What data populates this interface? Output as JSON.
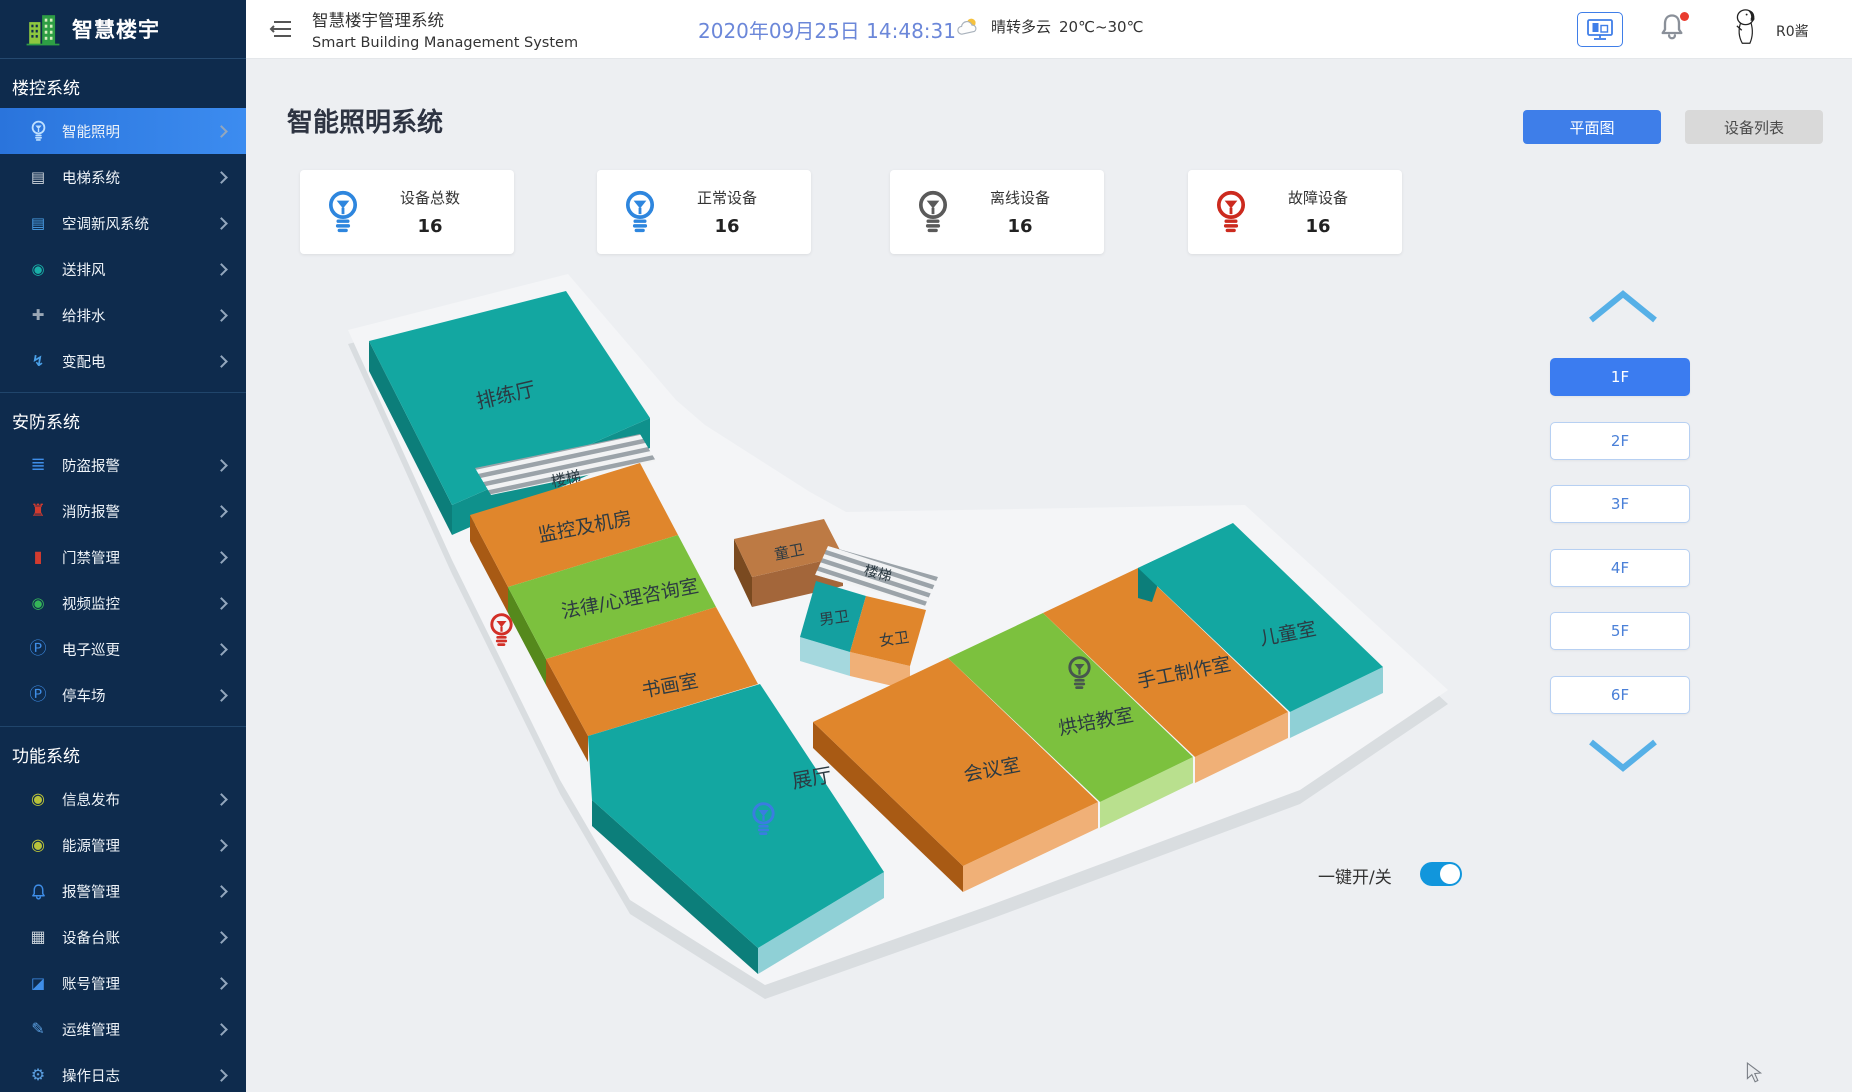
{
  "sidebar": {
    "logo_title": "智慧楼宇",
    "sections": [
      {
        "title": "楼控系统",
        "items": [
          {
            "label": "智能照明",
            "icon": "bulb-icon",
            "active": true
          },
          {
            "label": "电梯系统",
            "icon": "elevator-icon"
          },
          {
            "label": "空调新风系统",
            "icon": "air-conditioner-icon"
          },
          {
            "label": "送排风",
            "icon": "fan-icon"
          },
          {
            "label": "给排水",
            "icon": "water-valve-icon"
          },
          {
            "label": "变配电",
            "icon": "power-distribution-icon"
          }
        ]
      },
      {
        "title": "安防系统",
        "items": [
          {
            "label": "防盗报警",
            "icon": "burglar-alarm-icon"
          },
          {
            "label": "消防报警",
            "icon": "fire-hydrant-icon"
          },
          {
            "label": "门禁管理",
            "icon": "door-access-icon"
          },
          {
            "label": "视频监控",
            "icon": "camera-icon"
          },
          {
            "label": "电子巡更",
            "icon": "patrol-icon"
          },
          {
            "label": "停车场",
            "icon": "parking-icon"
          }
        ]
      },
      {
        "title": "功能系统",
        "items": [
          {
            "label": "信息发布",
            "icon": "info-publish-icon"
          },
          {
            "label": "能源管理",
            "icon": "energy-icon"
          },
          {
            "label": "报警管理",
            "icon": "alarm-bell-icon"
          },
          {
            "label": "设备台账",
            "icon": "device-ledger-icon"
          },
          {
            "label": "账号管理",
            "icon": "account-icon"
          },
          {
            "label": "运维管理",
            "icon": "ops-icon"
          },
          {
            "label": "操作日志",
            "icon": "log-icon"
          }
        ]
      }
    ]
  },
  "header": {
    "title": "智慧楼宇管理系统",
    "subtitle": "Smart Building Management System",
    "datetime": "2020年09月25日 14:48:31",
    "weather_condition": "晴转多云",
    "weather_temp": "20℃~30℃",
    "username": "R0酱"
  },
  "page": {
    "title": "智能照明系统",
    "btn_floorplan": "平面图",
    "btn_device_list": "设备列表"
  },
  "stats": [
    {
      "label": "设备总数",
      "value": "16",
      "color": "#2e86de"
    },
    {
      "label": "正常设备",
      "value": "16",
      "color": "#2e86de"
    },
    {
      "label": "离线设备",
      "value": "16",
      "color": "#5a5a5a"
    },
    {
      "label": "故障设备",
      "value": "16",
      "color": "#cc2a1e"
    }
  ],
  "floorplan": {
    "rooms": [
      "排练厅",
      "楼梯",
      "监控及机房",
      "法律/心理咨询室",
      "书画室",
      "展厅",
      "童卫",
      "楼梯",
      "男卫",
      "女卫",
      "会议室",
      "烘培教室",
      "手工制作室",
      "儿童室"
    ],
    "devices": [
      {
        "status": "fault",
        "color": "#d22f27"
      },
      {
        "status": "on",
        "color": "#3a7de0"
      },
      {
        "status": "offline",
        "color": "#47564e"
      }
    ]
  },
  "floor_selector": {
    "floors": [
      "1F",
      "2F",
      "3F",
      "4F",
      "5F",
      "6F"
    ],
    "active_floor": "1F"
  },
  "master_switch": {
    "label": "一键开/关",
    "state": "on"
  },
  "colors": {
    "accent_blue": "#3e7ee9",
    "sidebar_bg": "#0e2b4d",
    "active_item": "#2e7de4",
    "teal": "#13a7a1",
    "orange": "#e0862c",
    "green": "#7cc13e"
  }
}
